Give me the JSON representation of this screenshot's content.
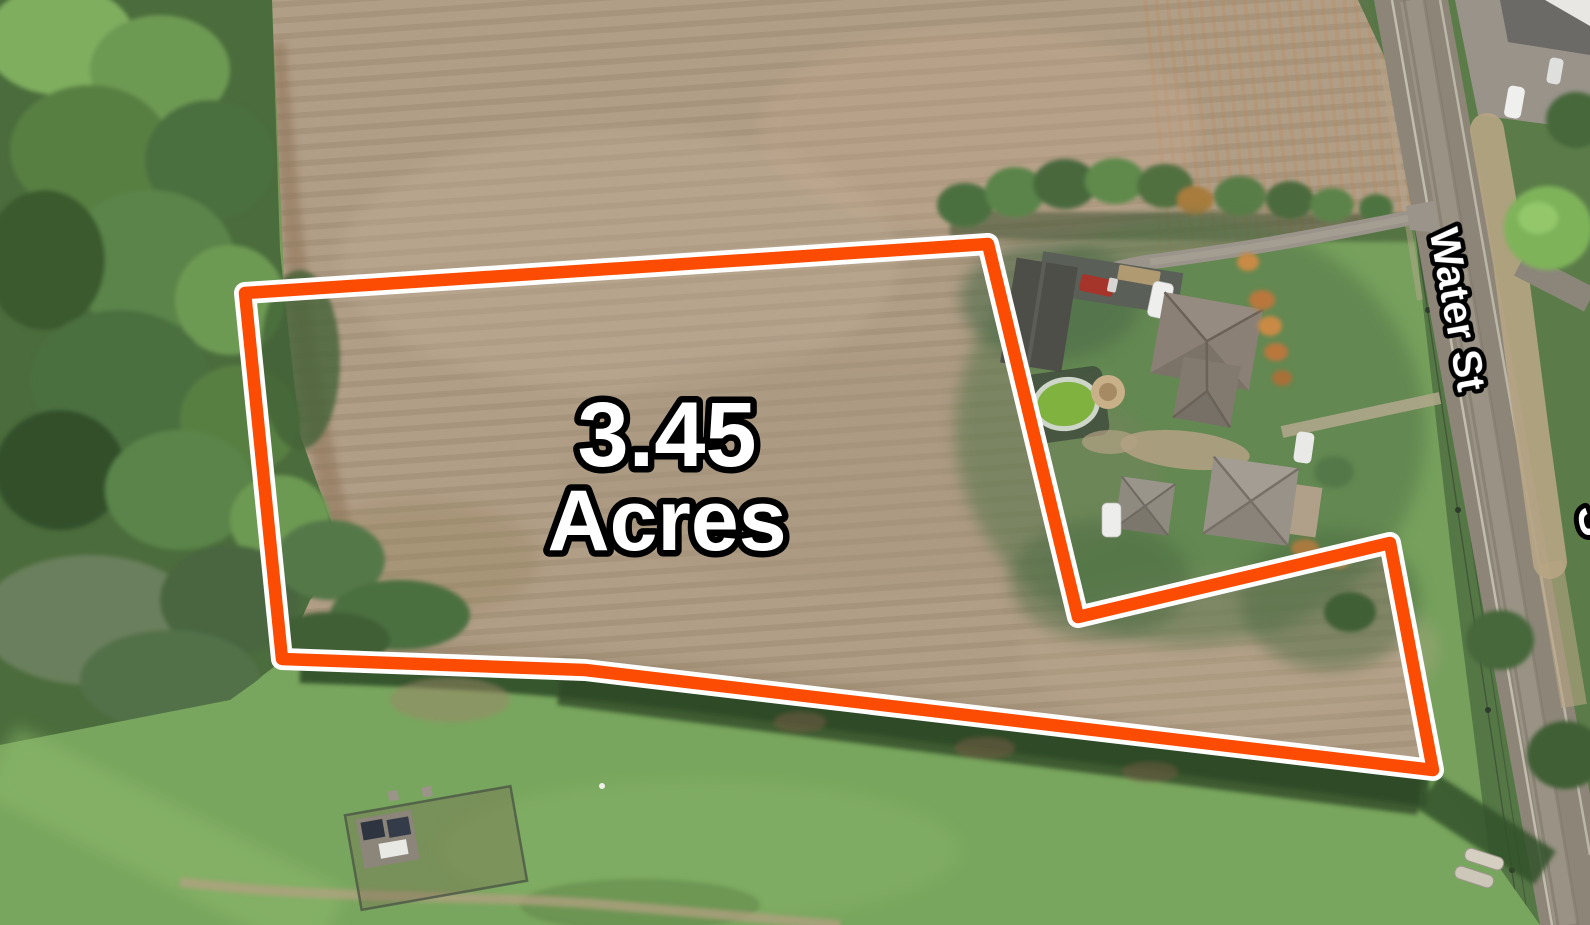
{
  "map": {
    "acreage_label": {
      "line1": "3.45",
      "line2": "Acres"
    },
    "street_label": "Water St",
    "partial_street_label": "S",
    "boundary": {
      "points": "245,293 988,244 1078,617 1390,543 1433,770 585,670 282,659",
      "stroke_color": "#fc4b02",
      "casing_color": "#ffffff"
    },
    "label_style": {
      "fill": "#ffffff",
      "outline": "#000000"
    },
    "colors": {
      "field": "#b19e87",
      "forest": "#4b6c3c",
      "lawn": "#76a05c",
      "bottom_grass": "#79a65e",
      "road": "#8d8678",
      "east_green": "#5b7c49"
    }
  }
}
